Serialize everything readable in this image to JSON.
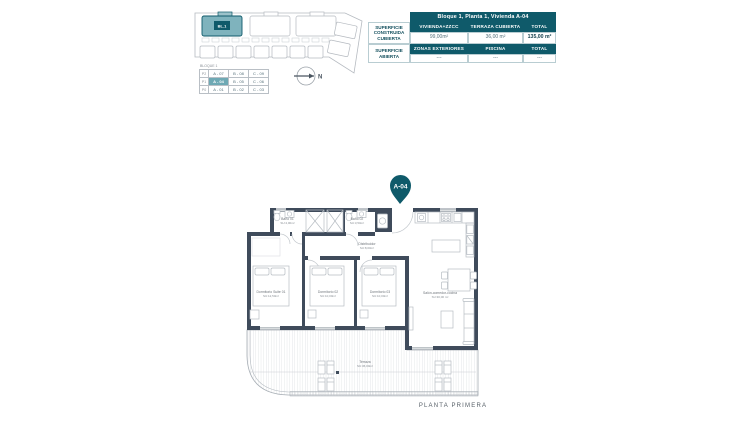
{
  "colors": {
    "teal_dark": "#0f5a6a",
    "teal_light": "#7fb3bd",
    "wall": "#3f4b5b"
  },
  "site_plan": {
    "block_label": "BL.1",
    "legend_title": "BLOQUE 1",
    "legend_rows": [
      {
        "floor": "P2",
        "a": "A - 07",
        "b": "B - 08",
        "c": "C - 09"
      },
      {
        "floor": "P1",
        "a": "A - 04",
        "b": "B - 05",
        "c": "C - 06"
      },
      {
        "floor": "P0",
        "a": "A - 01",
        "b": "B - 02",
        "c": "C - 03"
      }
    ],
    "north_label": "N"
  },
  "summary_table": {
    "title": "Bloque 1, Planta 1, Vivienda A-04",
    "left_labels": [
      "SUPERFICIE CONSTRUIDA CUBIERTA",
      "SUPERFICIE ABIERTA"
    ],
    "group1_headers": [
      "VIVIENDA+ZZCC",
      "TERRAZA CUBIERTA",
      "TOTAL"
    ],
    "group1_values": [
      "99,00m²",
      "36,00 m²",
      "135,00 m²"
    ],
    "group2_headers": [
      "ZONAS EXTERIORES",
      "PISCINA",
      "TOTAL"
    ],
    "group2_values": [
      "---",
      "---",
      "---"
    ]
  },
  "pin_label": "A-04",
  "floor_plan": {
    "caption": "PLANTA PRIMERA",
    "rooms": {
      "bano1": {
        "name": "Baño 01",
        "area": "SU:4,00m²"
      },
      "bano2": {
        "name": "Baño 02",
        "area": "SU:3,50m²"
      },
      "distribuidor": {
        "name": "Distribuidor",
        "area": "SU:8,00m²"
      },
      "suite": {
        "name": "Dormitorio Suite 01",
        "area": "SU:12,50m²"
      },
      "dorm2": {
        "name": "Dormitorio 02",
        "area": "SU:10,00m²"
      },
      "dorm3": {
        "name": "Dormitorio 03",
        "area": "SU:10,00m²"
      },
      "salon": {
        "name": "Salón-comedor-cocina",
        "area": "SU:30,00 m²"
      },
      "terraza": {
        "name": "Terraza",
        "area": "SU:36,00m²"
      }
    }
  }
}
